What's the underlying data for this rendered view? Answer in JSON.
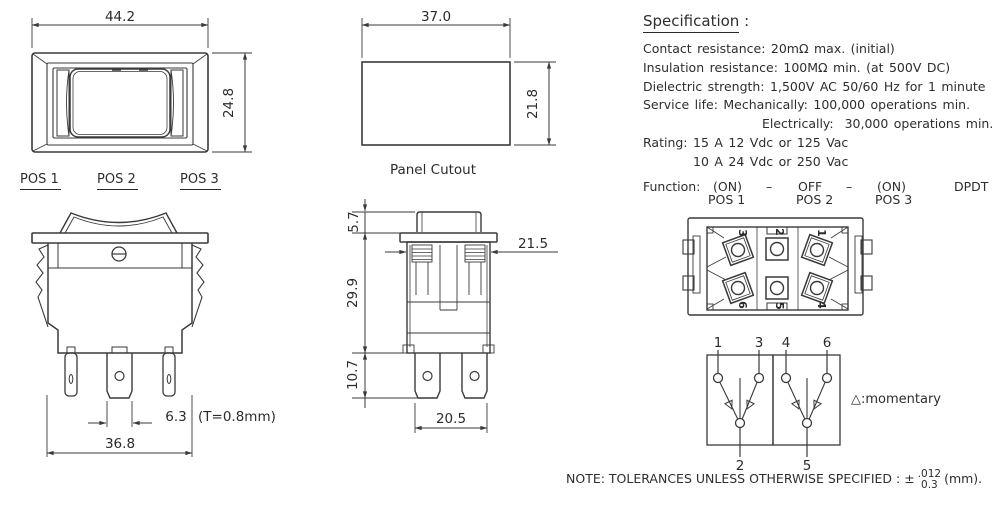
{
  "front_view": {
    "width_dim": "44.2",
    "height_dim": "24.8"
  },
  "position_labels": {
    "pos1": "POS 1",
    "pos2": "POS 2",
    "pos3": "POS 3"
  },
  "front_switch_view": {
    "terminal_width_dim": "6.3",
    "thickness_note": "(T=0.8mm)",
    "body_width_dim": "36.8"
  },
  "panel_cutout": {
    "width_dim": "37.0",
    "height_dim": "21.8",
    "caption": "Panel Cutout"
  },
  "side_view": {
    "actuator_height_dim": "5.7",
    "body_height_dim": "29.9",
    "terminal_length_dim": "10.7",
    "body_width_dim": "21.5",
    "terminal_span_dim": "20.5"
  },
  "bottom_view": {
    "terminal_numbers": {
      "t1": "1",
      "t2": "2",
      "t3": "3",
      "t4": "4",
      "t5": "5",
      "t6": "6"
    }
  },
  "schematic": {
    "terminal_top_1": "1",
    "terminal_top_3": "3",
    "terminal_top_4": "4",
    "terminal_top_6": "6",
    "terminal_bottom_2": "2",
    "terminal_bottom_5": "5",
    "momentary_note": "△:momentary"
  },
  "specification": {
    "heading": "Specification",
    "heading_colon": " :",
    "lines": [
      {
        "text": "Contact resistance: 20mΩ max. (initial)"
      },
      {
        "text": "Insulation resistance: 100MΩ min. (at 500V DC)"
      },
      {
        "text": "Dielectric strength: 1,500V AC 50/60 Hz for 1 minute"
      },
      {
        "text": "Service life: Mechanically: 100,000 operations min."
      },
      {
        "text": "Electrically:  30,000 operations min."
      },
      {
        "text": "Rating: 15 A 12 Vdc or 125 Vac"
      },
      {
        "text": "10 A 24 Vdc or 250 Vac"
      }
    ],
    "function_label": "Function:",
    "function_row": {
      "on1": "(ON)",
      "dash1": "–",
      "off": "OFF",
      "dash2": "–",
      "on2": "(ON)",
      "type": "DPDT"
    },
    "pos_row": {
      "pos1": "POS 1",
      "pos2": "POS 2",
      "pos3": "POS 3"
    }
  },
  "note": {
    "text": "NOTE: TOLERANCES UNLESS OTHERWISE SPECIFIED : ±",
    "tolerance_top": ".012",
    "tolerance_bottom": "0.3",
    "suffix": "(mm)."
  }
}
